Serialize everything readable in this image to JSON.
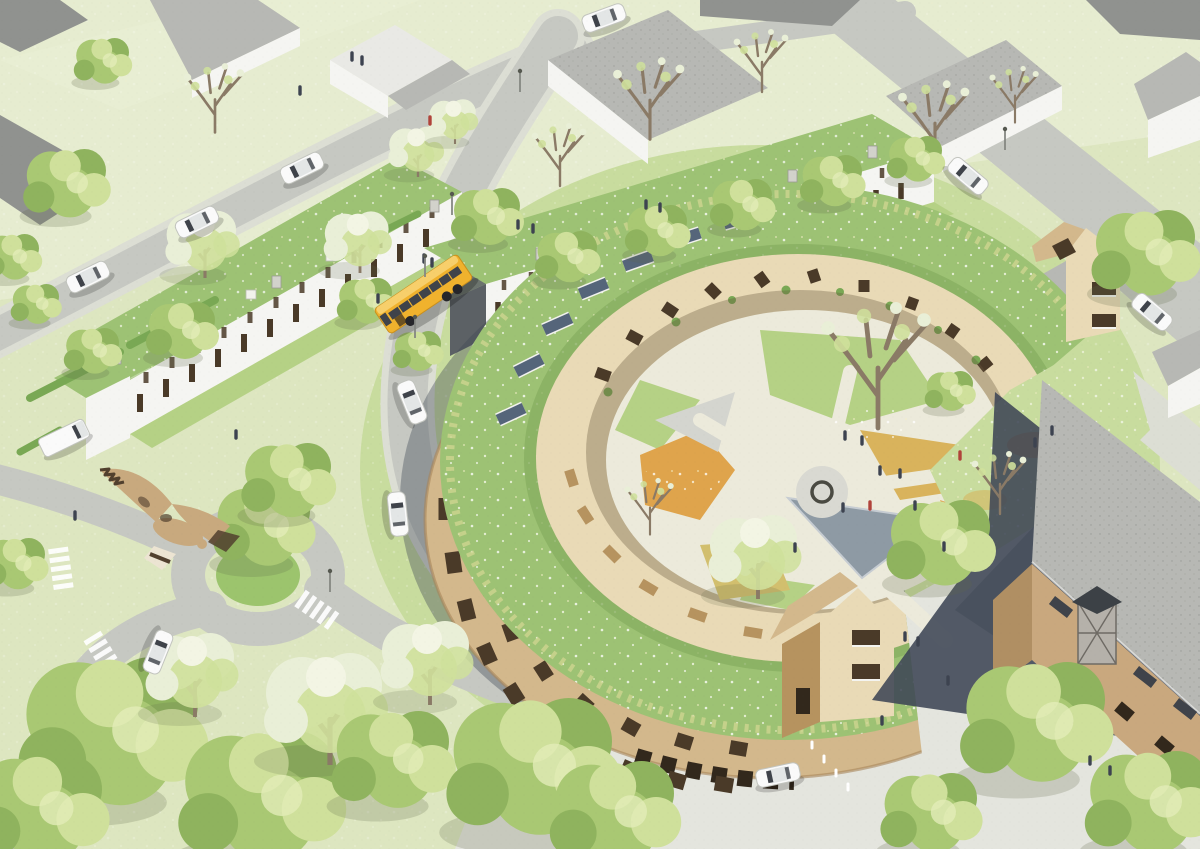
{
  "scene": {
    "type": "aerial-architectural-rendering",
    "setting": "suburban-neighborhood-masterplan",
    "focal_building": "circular timber apartment block with grass roof, solar panels and landscaped inner courtyard",
    "secondary_elements": [
      "two rows of terraced houses with sloped green roofs",
      "existing brick building with large grey hipped roof and glazed dormer",
      "detached context houses with grey pitched roofs",
      "roundabout with planted green island and tree",
      "yellow transit bus on curving street",
      "white cars and a white delivery van",
      "flying goose over the roundabout",
      "street trees, blossoming trees and large foreground canopies",
      "courtyard with radial paths, triangular pond, wildflower meadows and central fire-pit circle",
      "zebra crosswalks, street lamps, bollards, pedestrians"
    ],
    "vehicles": {
      "bus": 1,
      "cars": 9,
      "vans": 1
    },
    "birds": 1
  },
  "palette": {
    "grass_base": "#dde6c0",
    "grass_light": "#e8eed3",
    "grass_mid": "#c8dc9e",
    "lawn": "#b5d185",
    "island": "#9cc46d",
    "hedge": "#79a854",
    "road": "#c6c8c2",
    "sidewalk": "#dcded4",
    "plaza": "#e4e5de",
    "path_light": "#eceadb",
    "roof_green": "#9dc274",
    "roof_green_dk": "#88af62",
    "wood_light": "#e9dab6",
    "wood_mid": "#d3b88c",
    "wood_dark": "#b6935f",
    "window_dark": "#4a3a28",
    "opening_dark": "#32281c",
    "white_wall": "#f5f5f2",
    "grey_roof": "#b7b8b4",
    "grey_roof_dk": "#90928f",
    "dark_gable": "#5c6165",
    "tree_green": "#a9c873",
    "tree_light": "#cfe09b",
    "tree_dark": "#8fb35e",
    "blossom": "#e9efd7",
    "trunk": "#8a7a66",
    "brick": "#c9a87e",
    "brick_dk": "#b08f63",
    "shadow_navy": "#3e4655",
    "shadow_soft": "#5f6b4a",
    "bus_yellow": "#f0b22d",
    "bus_roof": "#f7cf6b",
    "glass": "#3f434a",
    "car_white": "#fafafa",
    "pool": "#8e9aa4",
    "wildflower_orange": "#dfa44c",
    "wildflower_amber": "#d9b35c",
    "reed": "#d2bf6e",
    "solar": "#55657a",
    "skylight": "#b9c2c8",
    "bird_tan": "#c8a97e",
    "bird_dark": "#51402e",
    "bird_cream": "#ece4d2",
    "people": "#3d4350",
    "people_accent": "#b0433a"
  }
}
